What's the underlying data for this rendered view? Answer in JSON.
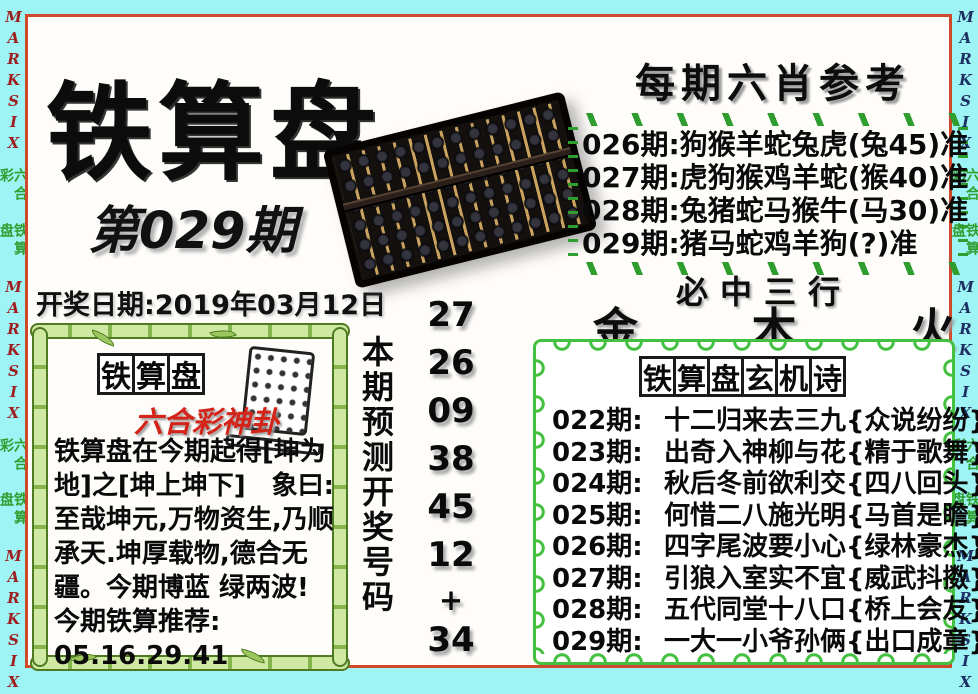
{
  "page": {
    "background": "#9ef4f4",
    "panel_border": "#d0492b",
    "panel_bg": "#fffdfa"
  },
  "edges": {
    "sequence": [
      "MARKSIX",
      "六合彩",
      "铁算盘",
      "MARKSIX",
      "六合彩",
      "铁算盘",
      "MARKSIX"
    ],
    "left_latin_color": "#9e1f1f",
    "right_latin_color": "#1d2f63",
    "cjk_color": "#2f9e2f"
  },
  "header": {
    "title": "铁算盘",
    "issue": "第029期",
    "draw_date": "开奖日期:2019年03月12日"
  },
  "six_xiao": {
    "title": "每期六肖参考",
    "dash_color": "#2f9e2f",
    "rows": [
      "026期:狗猴羊蛇兔虎(兔45)准",
      "027期:虎狗猴鸡羊蛇(猴40)准",
      "028期:兔猪蛇马猴牛(马30)准",
      "029期:猪马蛇鸡羊狗(?)准"
    ]
  },
  "three_rows": {
    "title": "必中三行",
    "elements": [
      "金",
      "木",
      "火"
    ]
  },
  "prediction": {
    "vertical_label": "本期预测开奖号码",
    "numbers": [
      "27",
      "26",
      "09",
      "38",
      "45",
      "12",
      "+",
      "34"
    ]
  },
  "mystery_poem": {
    "title_chars": [
      "铁",
      "算",
      "盘",
      "玄",
      "机",
      "诗"
    ],
    "border_color": "#44c040",
    "rows": [
      {
        "period": "022期:",
        "poem": "十二归来去三九",
        "hint": "{众说纷纷}"
      },
      {
        "period": "023期:",
        "poem": "出奇入神柳与花",
        "hint": "{精于歌舞}"
      },
      {
        "period": "024期:",
        "poem": "秋后冬前欲利交",
        "hint": "{四八回头}"
      },
      {
        "period": "025期:",
        "poem": "何惜二八施光明",
        "hint": "{马首是瞻}"
      },
      {
        "period": "026期:",
        "poem": "四字尾波要小心",
        "hint": "{绿林豪杰}"
      },
      {
        "period": "027期:",
        "poem": "引狼入室实不宜",
        "hint": "{威武抖擞}"
      },
      {
        "period": "028期:",
        "poem": "五代同堂十八口",
        "hint": "{桥上会友}"
      },
      {
        "period": "029期:",
        "poem": "一大一小爷孙俩",
        "hint": "{出口成章}"
      }
    ]
  },
  "oracle": {
    "title_chars": [
      "铁",
      "算",
      "盘"
    ],
    "subtitle": "六合彩神卦",
    "subtitle_color": "#d42318",
    "lines": [
      "铁算盘在今期起得[坤为",
      "地]之[坤上坤下]　象曰:",
      "至哉坤元,万物资生,乃顺",
      "承天.坤厚载物,德合无",
      "疆。今期博蓝 绿两波!",
      "今期铁算推荐:",
      "05.16.29.41"
    ]
  }
}
